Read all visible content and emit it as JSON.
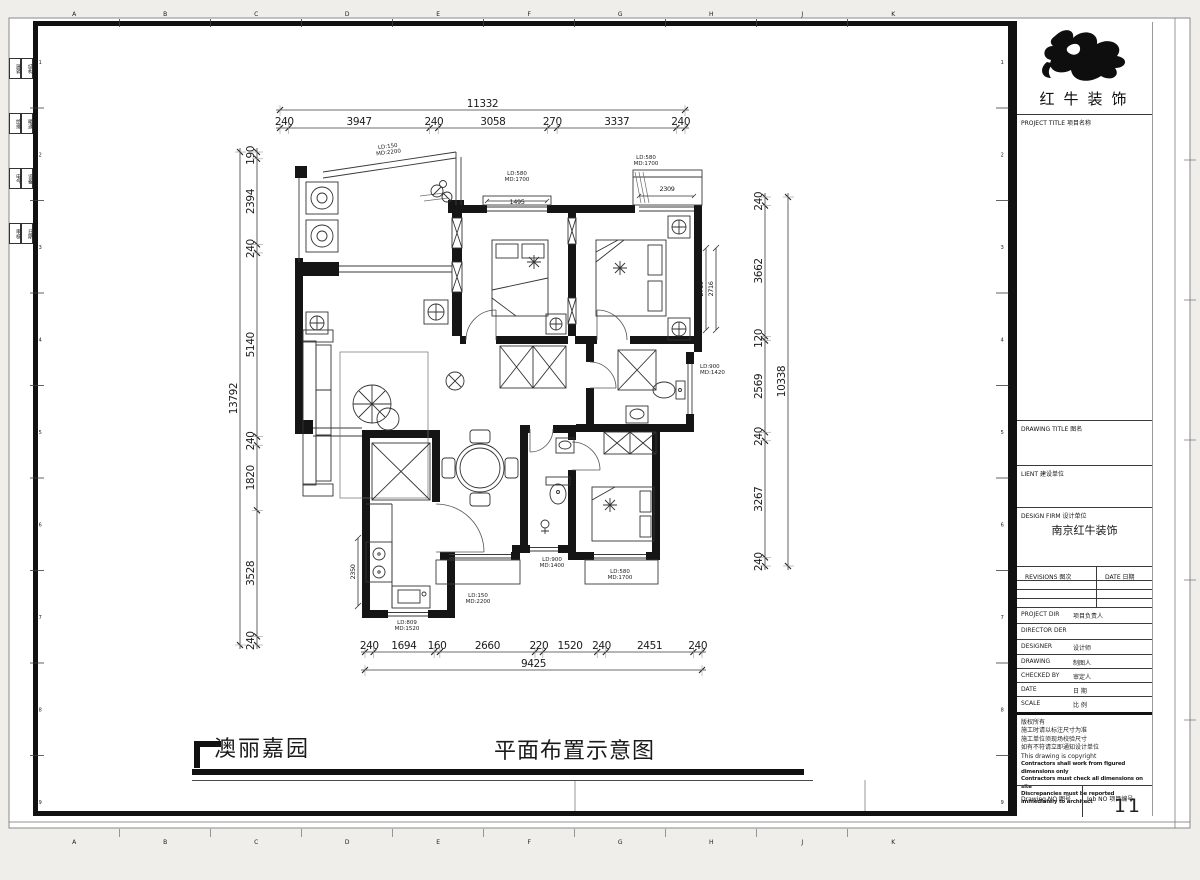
{
  "footer": {
    "project_name": "澳丽嘉园",
    "drawing_name": "平面布置示意图"
  },
  "title_block": {
    "logo_icon": "bull-swoosh",
    "brand": "红牛装饰",
    "project_title_label": "PROJECT TITLE  项目名称",
    "drawing_title_label": "DRAWING TITLE  图名",
    "client_label": "LIENT  建设单位",
    "design_firm_label": "DESIGN FIRM  设计单位",
    "design_firm_value": "南京红牛装饰",
    "revisions_label": "REVISIONS  图次",
    "date_col_label": "DATE  日期",
    "project_dir_label": "PROJECT DIR",
    "project_dir_cn": "项目负责人",
    "director_label": "DIRECTOR DER",
    "designer_label": "DESIGNER",
    "designer_cn": "设计师",
    "drawing_label": "DRAWING",
    "drawing_cn": "制图人",
    "checked_label": "CHECKED BY",
    "checked_cn": "审定人",
    "date_label": "DATE",
    "date_cn": "日 期",
    "scale_label": "SCALE",
    "scale_cn": "比 例",
    "copyright_lines": [
      "版权所有",
      "施工时请以标注尺寸为准",
      "施工单位须现场校验尺寸",
      "如有不符请立即通知设计单位",
      "This drawing is copyright"
    ],
    "copyright_bold_lines": [
      "Contractors shall work from figured dimensions only",
      "Contractors must check all dimensions on site",
      "Discrepancies must be reported immediately to architect"
    ],
    "drawing_no_label": "Drawing NO  图号",
    "job_no_label": "Job NO  项目编号",
    "job_no_value": "11"
  },
  "grid": {
    "top_letters": [
      "A",
      "B",
      "C",
      "D",
      "E",
      "F",
      "G",
      "H",
      "J",
      "K"
    ],
    "side_numbers": [
      "1",
      "2",
      "3",
      "4",
      "5",
      "6",
      "7",
      "8",
      "9"
    ]
  },
  "margin_boxes": [
    {
      "a": "建筑",
      "b": "结构"
    },
    {
      "a": "给排",
      "b": "暖通"
    },
    {
      "a": "电气",
      "b": "设备"
    },
    {
      "a": "审核",
      "b": "日期"
    }
  ],
  "dimensions": {
    "top": {
      "total": "11332",
      "segments": [
        240,
        3947,
        240,
        3058,
        270,
        3337,
        240
      ]
    },
    "left": {
      "total": "13792",
      "segments": [
        190,
        2394,
        240,
        5140,
        240,
        1820,
        3528,
        240
      ]
    },
    "right": {
      "total": "10338",
      "segments": [
        240,
        3662,
        120,
        2569,
        240,
        3267,
        240
      ]
    },
    "bottom": {
      "total": "9425",
      "segments": [
        240,
        1694,
        160,
        2660,
        220,
        1520,
        240,
        2451,
        240
      ]
    }
  },
  "window_labels": [
    {
      "l1": "LD:150",
      "l2": "MD:2200"
    },
    {
      "l1": "LD:580",
      "l2": "MD:1700"
    },
    {
      "l1": "LD:580",
      "l2": "MD:1700"
    },
    {
      "l1": "LD:900",
      "l2": "MD:1420"
    },
    {
      "l1": "LD:580",
      "l2": "MD:1700"
    },
    {
      "l1": "LD:900",
      "l2": "MD:1400"
    },
    {
      "l1": "LD:150",
      "l2": "MD:2200"
    },
    {
      "l1": "LD:809",
      "l2": "MD:1520"
    }
  ],
  "interior_dims": [
    "1495",
    "2309",
    "2716",
    "2716",
    "2350"
  ]
}
